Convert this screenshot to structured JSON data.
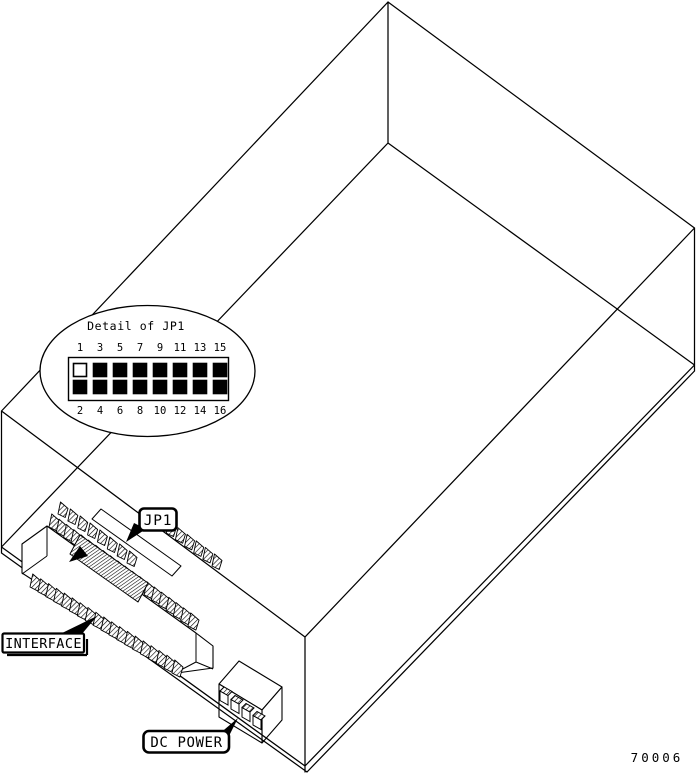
{
  "diagram": {
    "background_color": "#ffffff",
    "line_color": "#000000",
    "part_number": "70006",
    "callout": {
      "title": "Detail of JP1",
      "top_pin_numbers": [
        "1",
        "3",
        "5",
        "7",
        "9",
        "11",
        "13",
        "15"
      ],
      "bottom_pin_numbers": [
        "2",
        "4",
        "6",
        "8",
        "10",
        "12",
        "14",
        "16"
      ],
      "top_pins_filled": [
        false,
        true,
        true,
        true,
        true,
        true,
        true,
        true
      ],
      "bottom_pins_filled": [
        true,
        true,
        true,
        true,
        true,
        true,
        true,
        true
      ]
    },
    "labels": {
      "jp1": "JP1",
      "interface": "INTERFACE",
      "dc_power": "DC POWER"
    }
  }
}
